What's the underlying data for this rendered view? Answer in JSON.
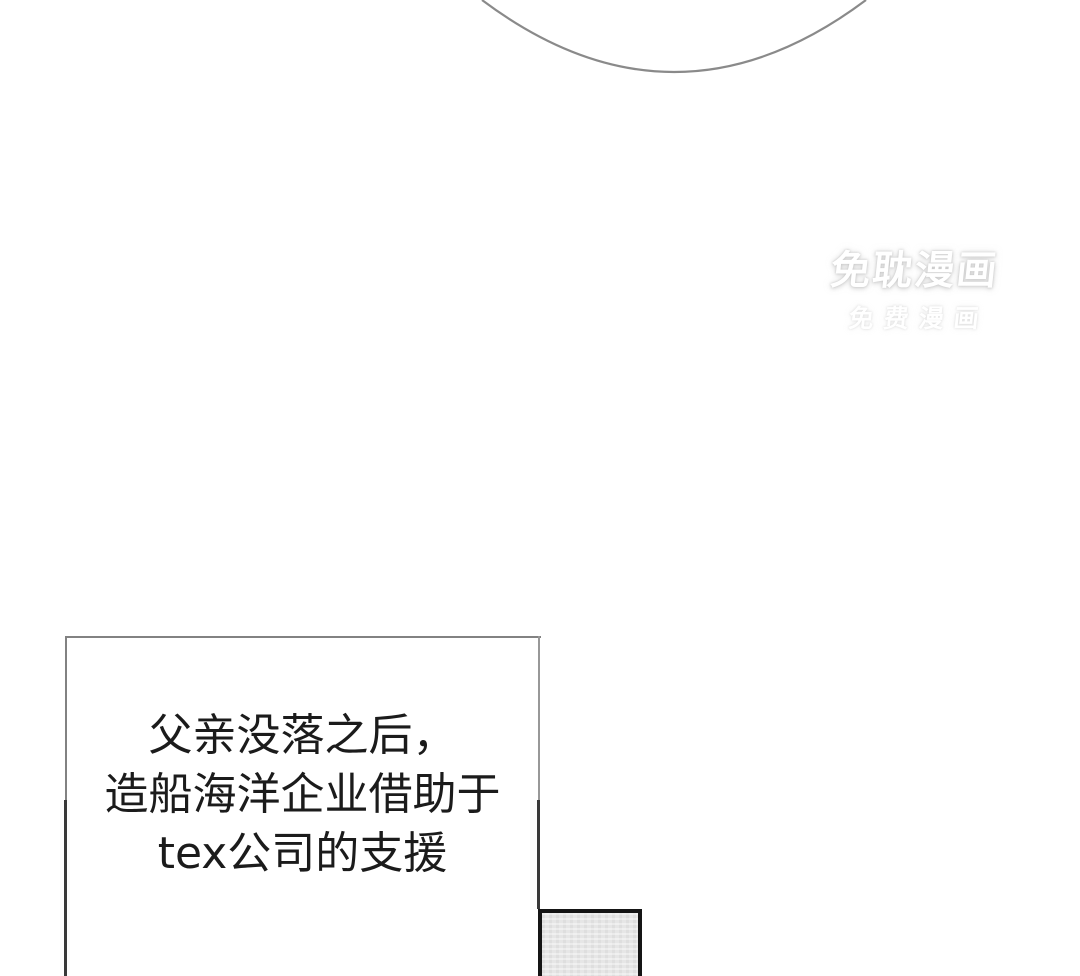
{
  "page": {
    "background_color": "#ffffff",
    "width": 1080,
    "height": 976
  },
  "bubble_arc": {
    "stroke_color": "#8a8a8a",
    "path": "M 482 0 Q 674 144 866 0"
  },
  "watermark": {
    "line1": "免耽漫画",
    "line2": "免费漫画",
    "color": "#ffffff"
  },
  "speech_box": {
    "lines": [
      "父亲没落之后，",
      "造船海洋企业借助于",
      "tex公司的支援"
    ],
    "text_color": "#1b1b1b",
    "border_color_upper": "#828282",
    "border_color_lower": "#3a3a3a"
  },
  "panel_box": {
    "fill_color": "#e6e6e6",
    "border_color": "#151515"
  }
}
